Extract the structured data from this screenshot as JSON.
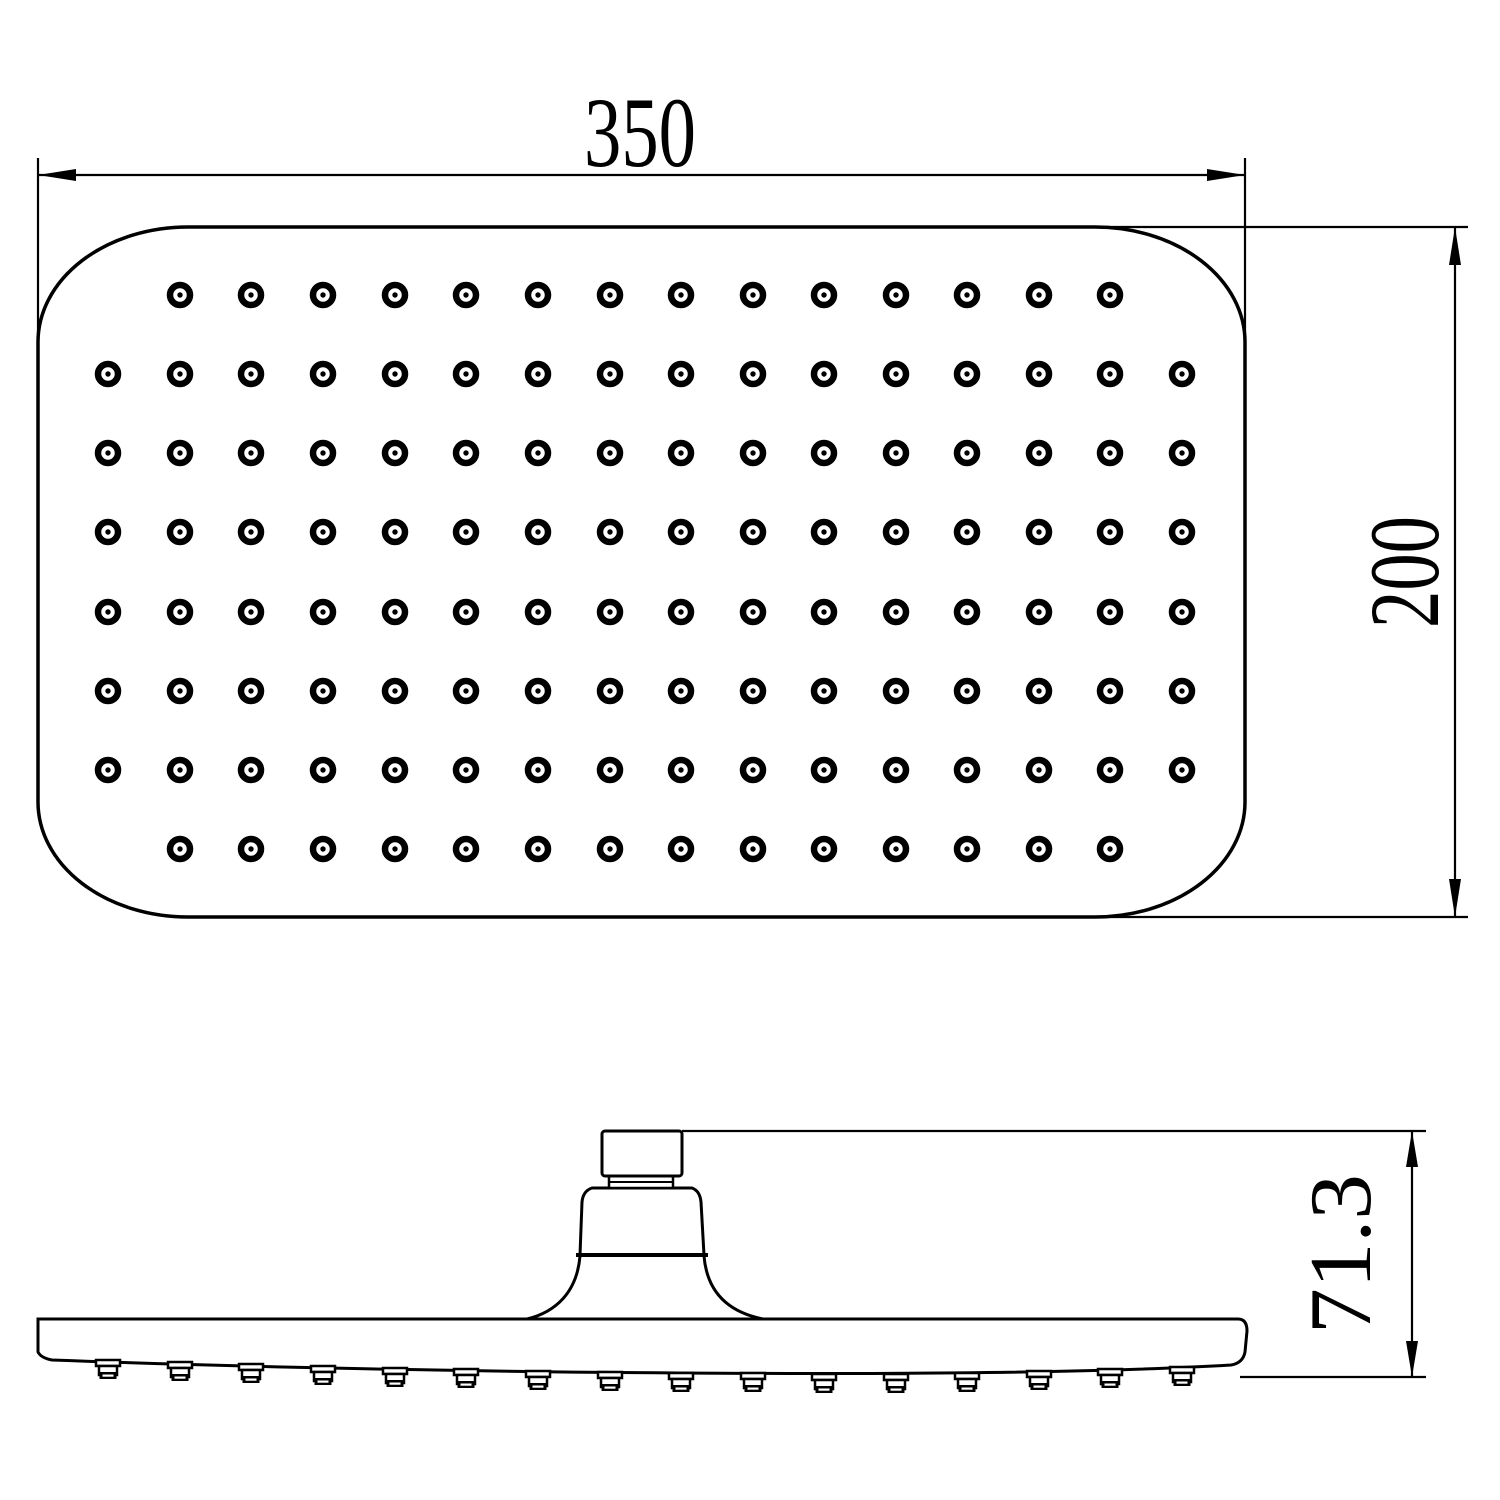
{
  "drawing": {
    "title": "shower-head-technical-drawing",
    "background_color": "#ffffff",
    "line_color": "#000000",
    "dimensions": {
      "width_label": "350",
      "height_label": "200",
      "side_height_label": "71.3"
    },
    "top_view": {
      "outline": {
        "x": 38,
        "y": 227,
        "width": 1207,
        "height": 690,
        "corner_rx": 150,
        "corner_ry": 115
      },
      "holes": {
        "columns_x": [
          108,
          180,
          251,
          323,
          395,
          466,
          538,
          610,
          681,
          753,
          824,
          896,
          967,
          1039,
          1110,
          1182
        ],
        "rows": [
          {
            "y": 295,
            "col_start": 1,
            "col_end": 14
          },
          {
            "y": 374,
            "col_start": 0,
            "col_end": 15
          },
          {
            "y": 453,
            "col_start": 0,
            "col_end": 15
          },
          {
            "y": 532,
            "col_start": 0,
            "col_end": 15
          },
          {
            "y": 612,
            "col_start": 0,
            "col_end": 15
          },
          {
            "y": 691,
            "col_start": 0,
            "col_end": 15
          },
          {
            "y": 770,
            "col_start": 0,
            "col_end": 15
          },
          {
            "y": 849,
            "col_start": 1,
            "col_end": 14
          }
        ],
        "outer_ring_radius": 10,
        "ring_stroke_width": 6.5,
        "center_dot_radius": 2.7
      }
    },
    "side_view": {
      "nozzle_face_y": [
        1361,
        1363,
        1365,
        1367,
        1369,
        1370,
        1372,
        1373,
        1374,
        1374,
        1375,
        1375,
        1374,
        1372,
        1370,
        1368
      ],
      "nozzle_count": 16
    }
  }
}
